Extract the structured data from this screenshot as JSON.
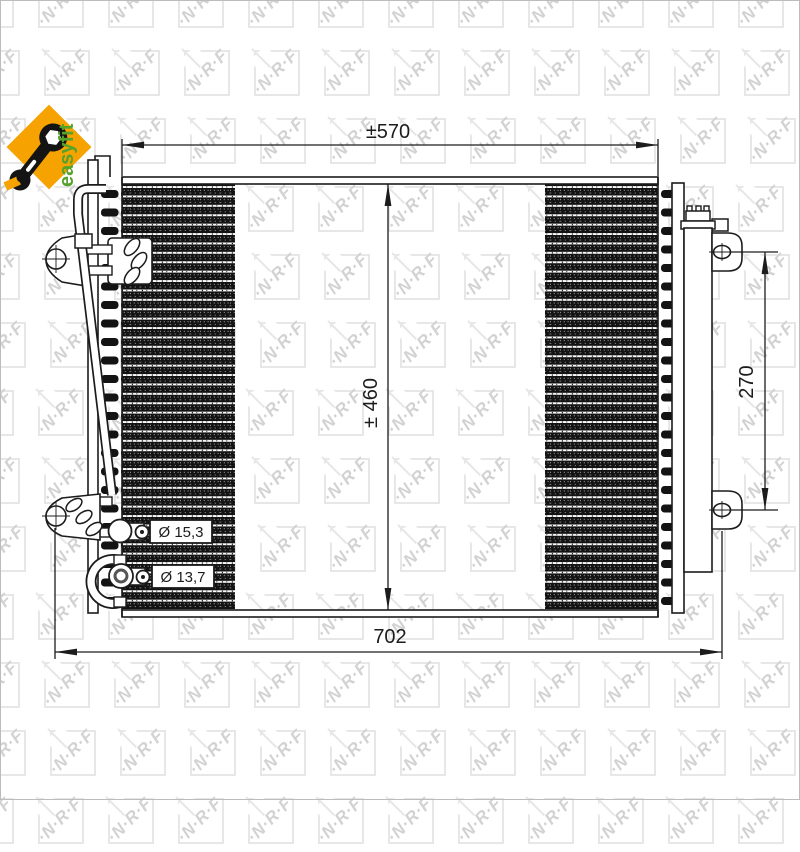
{
  "page": {
    "background": "#ffffff",
    "border_color": "#bcbcbc"
  },
  "watermark": {
    "text": "∙N∙R∙F",
    "square_color": "#e7e7e7",
    "text_color": "#d2d2d2"
  },
  "easyfit_badge": {
    "label": "easyfit",
    "diamond_color": "#f6a200",
    "label_color": "#55a32b",
    "icon": "wrench-icon",
    "icon_color": "#141414"
  },
  "drawing": {
    "title": "NRF condenser technical drawing",
    "line_color": "#1c1c1c",
    "fin_color": "#131313",
    "dimensions": {
      "core_width": "±570",
      "core_height": "± 460",
      "drier_height": "270",
      "overall_width": "702"
    },
    "ports": [
      {
        "label": "Ø 15,3"
      },
      {
        "label": "Ø 13,7"
      }
    ]
  }
}
